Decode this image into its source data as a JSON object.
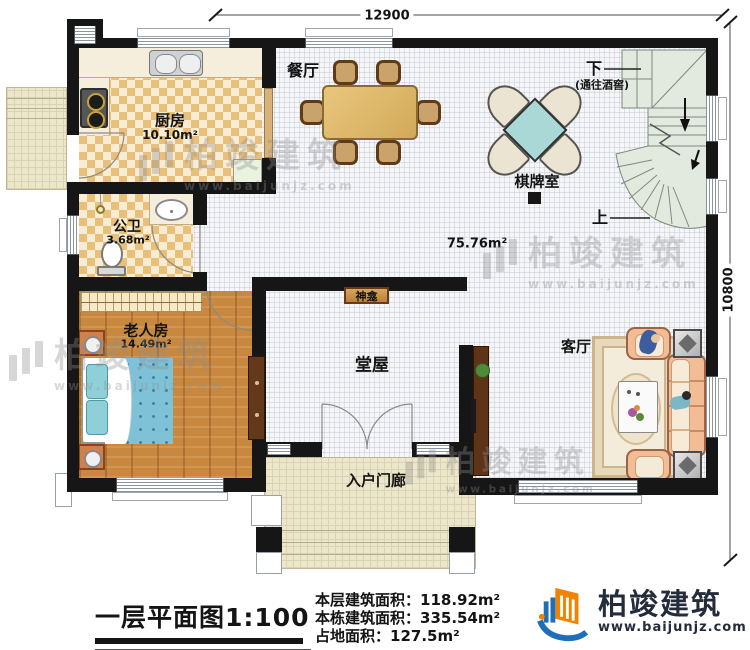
{
  "plan": {
    "scale_title": "一层平面图1:100",
    "dim_top": "12900",
    "dim_right": "10800",
    "open_area": "75.76m²",
    "rooms": {
      "dining": "餐厅",
      "kitchen": "厨房",
      "kitchen_area": "10.10m²",
      "bath": "公卫",
      "bath_area": "3.68m²",
      "elder": "老人房",
      "elder_area": "14.49m²",
      "hall": "堂屋",
      "porch": "入户门廊",
      "living": "客厅",
      "chess": "棋牌室",
      "shrine": "神龛"
    },
    "stairs": {
      "down": "下",
      "down_note": "(通往酒窖)",
      "up": "上"
    }
  },
  "footer": {
    "line1_label": "本层建筑面积：",
    "line1_value": "118.92m²",
    "line2_label": "本栋建筑面积：",
    "line2_value": "335.54m²",
    "line3_label": "占地面积：",
    "line3_value": "127.5m²",
    "line4_label": "层高：",
    "line4_value": "3.6m"
  },
  "brand": {
    "name": "柏竣建筑",
    "site": "www.baijunjz.com"
  },
  "watermark": {
    "name": "柏竣建筑",
    "site": "www.baijunjz.com"
  },
  "colors": {
    "wall": "#161616",
    "checker": "#e8c07c",
    "wood": "#c8883f",
    "mahjong_teal": "#a9d8d6",
    "logo_orange": "#f08300",
    "logo_blue": "#1e6fb8",
    "brand_navy": "#242c3c"
  }
}
